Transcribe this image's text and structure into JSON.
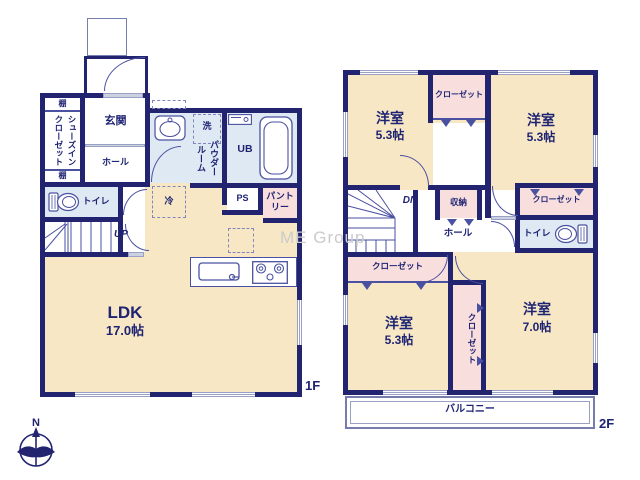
{
  "watermark": "ME Group",
  "compass": {
    "north": "N"
  },
  "floor1": {
    "label": "1F",
    "ldk": {
      "name": "LDK",
      "size": "17.0帖"
    },
    "genkan": "玄関",
    "hall": "ホール",
    "shoes_in_closet": "シューズインクローゼット",
    "shelf_top": "棚",
    "shelf_bottom": "棚",
    "toilet": "トイレ",
    "stairs": "UP",
    "wash": "洗",
    "powder_room": "パウダールーム",
    "unit_bath": "UB",
    "pipe_space": "PS",
    "pantry": "パントリー",
    "fridge": "冷"
  },
  "floor2": {
    "label": "2F",
    "bedrooms": [
      {
        "name": "洋室",
        "size": "5.3帖"
      },
      {
        "name": "洋室",
        "size": "5.3帖"
      },
      {
        "name": "洋室",
        "size": "5.3帖"
      },
      {
        "name": "洋室",
        "size": "7.0帖"
      }
    ],
    "closets": [
      "クローゼット",
      "クローゼット",
      "クローゼット",
      "クローゼット"
    ],
    "storage": "収納",
    "hall": "ホール",
    "toilet": "トイレ",
    "stairs": "DN",
    "balcony": "バルコニー"
  },
  "colors": {
    "wall": "#232470",
    "room_beige": "#f7e7c4",
    "wet_blue": "#dfe9f4",
    "closet_pink": "#f9dede",
    "ink": "#1e2473",
    "window_line": "#9aa0c4",
    "watermark": "#cbcbcb"
  }
}
